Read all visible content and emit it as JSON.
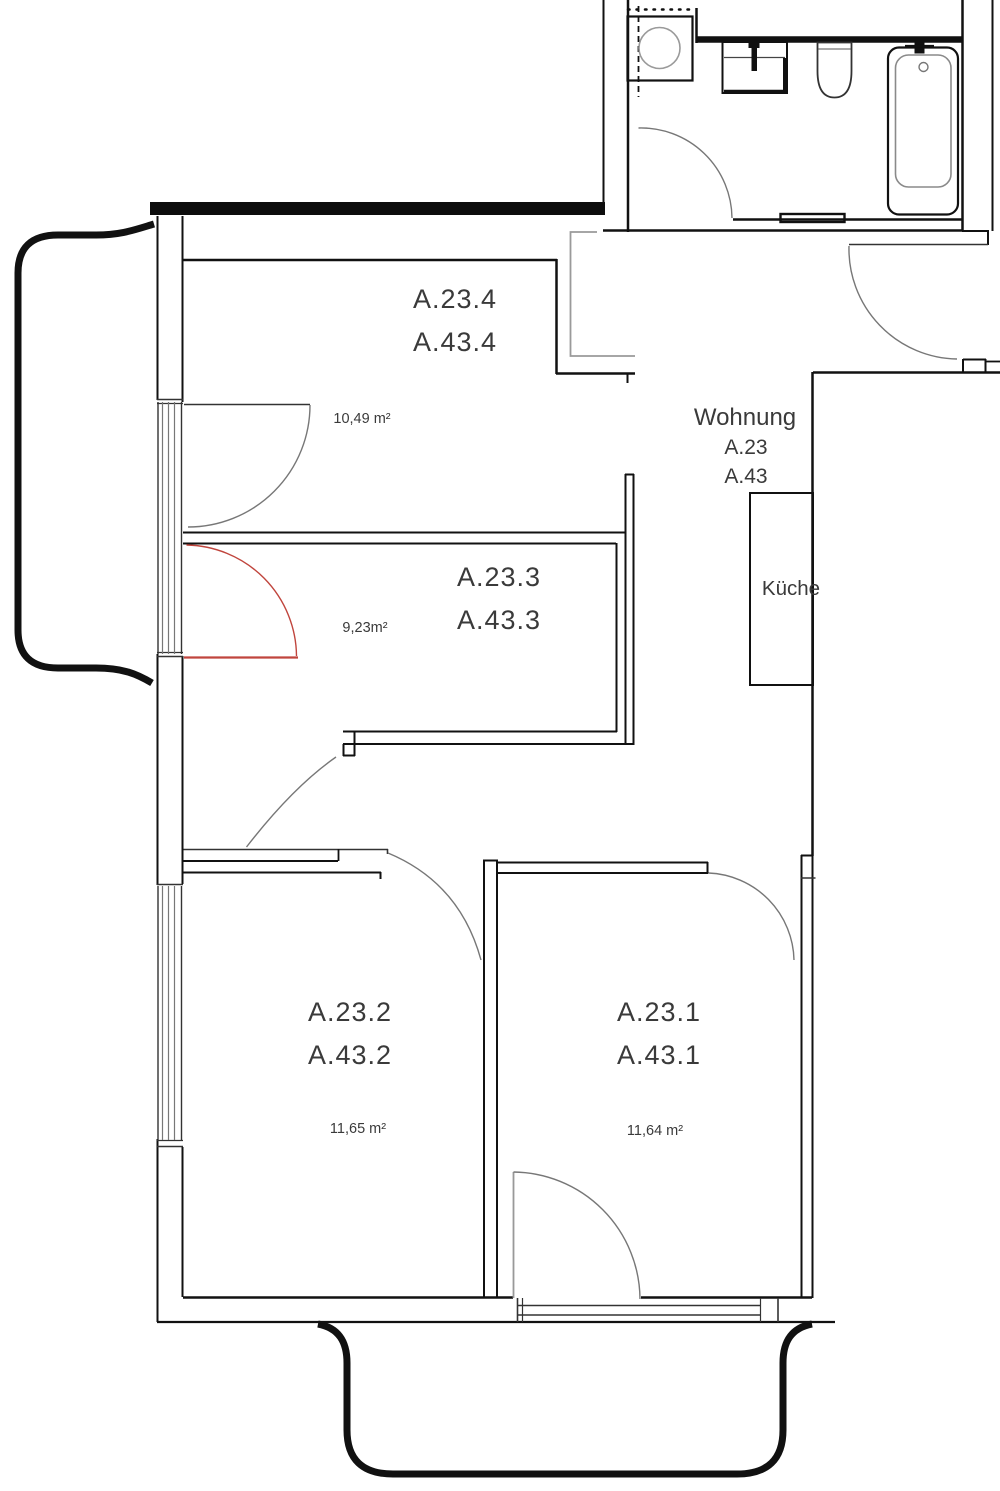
{
  "apartment": {
    "name": "Wohnung",
    "unit_a": "A.23",
    "unit_b": "A.43"
  },
  "kitchen": {
    "label": "Küche"
  },
  "rooms": [
    {
      "label_a": "A.23.4",
      "label_b": "A.43.4",
      "area": "10,49 m²"
    },
    {
      "label_a": "A.23.3",
      "label_b": "A.43.3",
      "area": "9,23m²"
    },
    {
      "label_a": "A.23.2",
      "label_b": "A.43.2",
      "area": "11,65 m²"
    },
    {
      "label_a": "A.23.1",
      "label_b": "A.43.1",
      "area": "11,64 m²"
    }
  ],
  "colors": {
    "wall": "#111111",
    "door_arc": "#777777",
    "escape_door": "#c0453d",
    "shaft": "#9a9a9a",
    "fixture_light": "#8a8a8a"
  }
}
